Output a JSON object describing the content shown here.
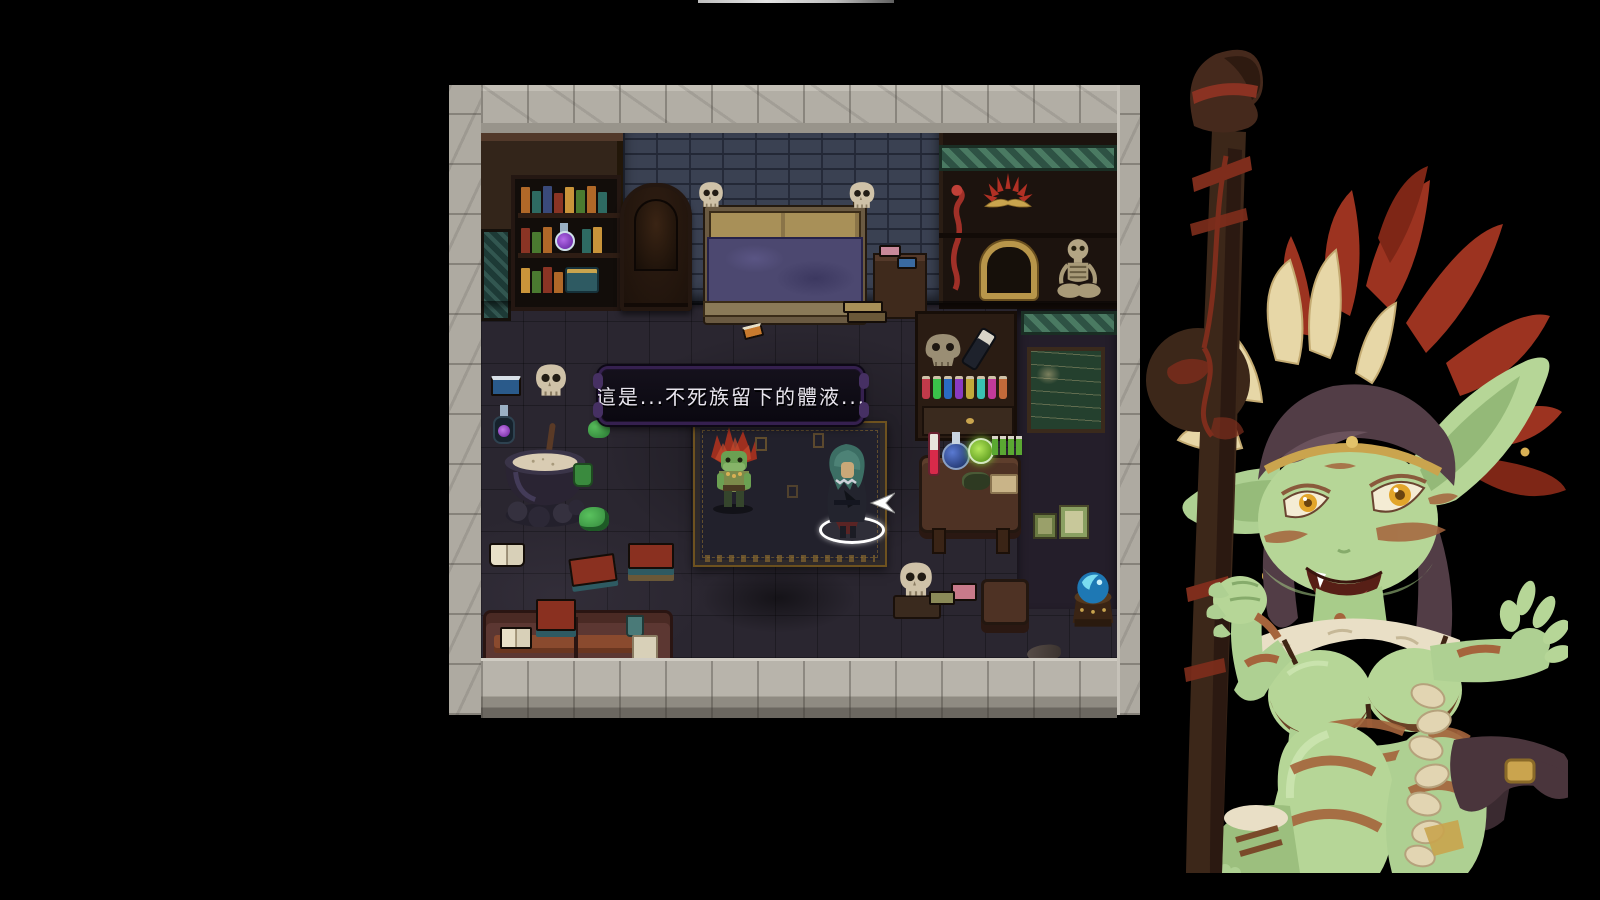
{
  "screen": {
    "background_color": "#000000",
    "top_edge_highlight": {
      "name": "window-top-edge",
      "color": "#cfcfcf"
    }
  },
  "dialogue_box": {
    "text": "這是...不死族留下的體液...",
    "text_color": "#e9e6ee",
    "background": "#0c0a13",
    "border_color": "#35204f",
    "speaker_indicator": "white-down-triangle"
  },
  "game_viewport": {
    "frame_stone_color": "#b2aea5",
    "floor_color": "#2a2630",
    "wall_brick_color": "#3a4152",
    "cabinet_trim_color": "#2e5244",
    "scene_items": [
      {
        "name": "bookshelf",
        "color": "#241712"
      },
      {
        "name": "wardrobe-panel",
        "color": "#33251a"
      },
      {
        "name": "tapestry-door",
        "color": "#1d3a36"
      },
      {
        "name": "ornate-throne",
        "color": "#1c110a"
      },
      {
        "name": "skull-post-bed",
        "blanket_color": "#4c4870"
      },
      {
        "name": "bedside-table",
        "color": "#3f2a1c"
      },
      {
        "name": "display-cabinet",
        "items": [
          "red-staff",
          "feather-headdress",
          "gold-arch-frame",
          "seated-skeleton"
        ]
      },
      {
        "name": "potion-cabinet",
        "potion_colors": [
          "#c23a4a",
          "#3ac24a",
          "#2a6ac2",
          "#8a3ac2",
          "#c2aa3a",
          "#3ac2b2",
          "#c23a9a",
          "#c26a3a"
        ]
      },
      {
        "name": "chalkboard",
        "color": "#24402e"
      },
      {
        "name": "cauldron",
        "contents_color": "#d9ccb3"
      },
      {
        "name": "wall-skull"
      },
      {
        "name": "floor-skull"
      },
      {
        "name": "green-slime",
        "color": "#3aa04a"
      },
      {
        "name": "purple-potion",
        "color": "#8a3ad8"
      },
      {
        "name": "blue-grimoire",
        "color": "#2a5a8a"
      },
      {
        "name": "open-book",
        "color": "#e8e0c8"
      },
      {
        "name": "scattered-books",
        "color": "#8a3020"
      },
      {
        "name": "sofa",
        "color": "#5c3732"
      },
      {
        "name": "ritual-carpet",
        "rune_color": "#8a6a2f"
      },
      {
        "name": "alchemy-table",
        "flask_colors": [
          "#d82a4a",
          "#274b9c",
          "#7cc832"
        ]
      },
      {
        "name": "crystal-ball",
        "color": "#2a9ad8"
      },
      {
        "name": "rat-sack",
        "color": "#4a4038"
      }
    ]
  },
  "entities": {
    "npc": {
      "name": "goblin-shaman-npc",
      "crest_color": "#9e2f1f",
      "skin_color": "#6ba052",
      "indicator": "white-down-triangle"
    },
    "player": {
      "name": "cloaked-adventurer",
      "hair_color": "#3c6e64",
      "coat_color": "#23242e",
      "selection_ring_color": "#ffffff"
    },
    "cursor": {
      "name": "white-arrow-cursor",
      "color": "#ffffff"
    }
  },
  "portrait": {
    "name": "goblin-shaman-portrait",
    "skin_color": "#b6d697",
    "hair_color": "#523d46",
    "eye_color": "#e2a52a",
    "red_feather_color": "#9c3320",
    "cream_feather_color": "#e7d7a7",
    "war_paint_color": "#a5643c",
    "staff_color": "#3c2719",
    "staff_wrap_color": "#7e2d1c",
    "gold_color": "#caa44e",
    "fur_color": "#e9dfc6"
  }
}
